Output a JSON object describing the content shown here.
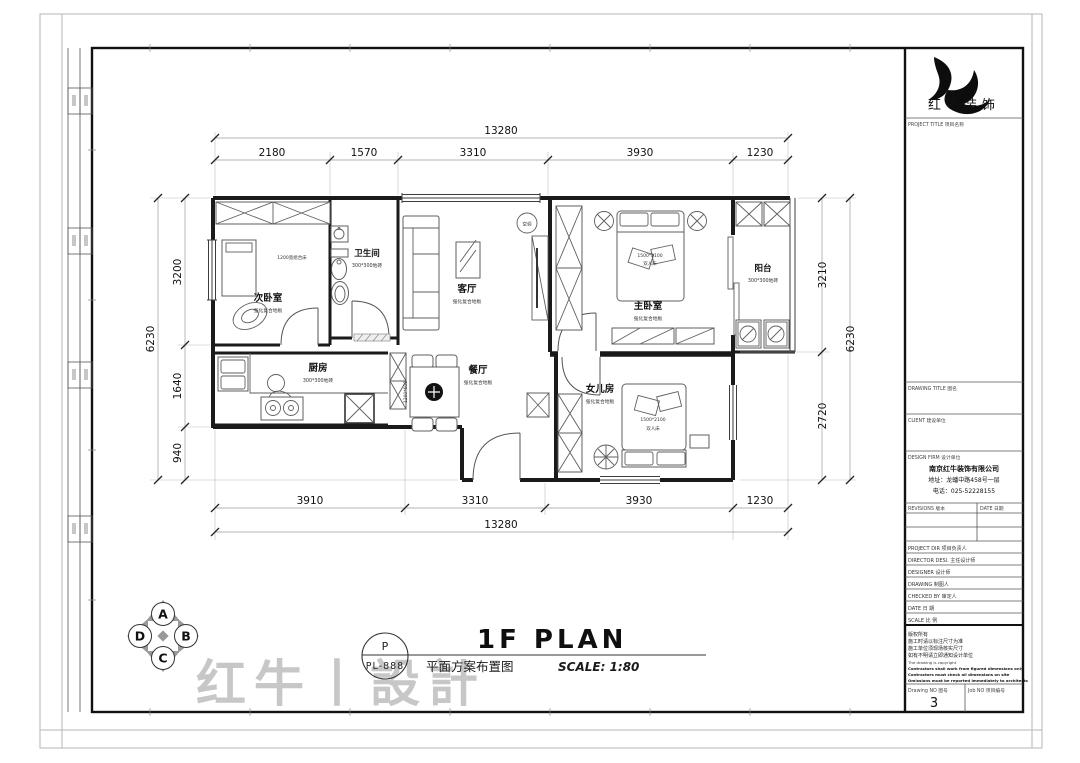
{
  "sheet": {
    "plan_title_en": "1F PLAN",
    "plan_title_cn": "平面方案布置图",
    "scale_note": "SCALE: 1:80",
    "stamp_letter": "P",
    "stamp_code": "PL-888",
    "watermark": "红牛丨設計",
    "compass": {
      "top": "A",
      "right": "B",
      "bottom": "C",
      "left": "D"
    }
  },
  "title_block": {
    "company_logo_text": "红牛装饰",
    "project_title_label": "PROJECT TITLE 项目名称",
    "drawing_title_label": "DRAWING TITLE 图名",
    "client_label": "CLIENT 建设单位",
    "design_firm_label": "DESIGN FIRM 设计单位",
    "firm_name": "南京红牛装饰有限公司",
    "firm_address": "地址：龙蟠中路458号一层",
    "firm_phone": "电话：025-52228155",
    "revisions_label": "REVISIONS 版本",
    "date_col_label": "DATE 日期",
    "rows": {
      "project_dir": "PROJECT DIR  项目负责人",
      "director": "DIRECTOR DESI.  主任设计师",
      "designer": "DESIGNER  设计师",
      "drawing": "DRAWING  制图人",
      "checked": "CHECKED BY  审定人",
      "date": "DATE  日  期",
      "scale": "SCALE  比  例"
    },
    "notes": {
      "l1": "版权所有",
      "l2": "施工时请以标注尺寸为准",
      "l3": "施工单位须现场核实尺寸",
      "l4": "如有不明请立即通知设计单位",
      "l5": "The drawing is copyright",
      "l6": "Contractors shall work from figured dimensions only",
      "l7": "Contractors must check all dimensions on site",
      "l8": "Omissions must be reported immediately to architects"
    },
    "drawing_no_label": "Drawing NO  图号",
    "drawing_no_value": "3",
    "job_no_label": "Job NO  项目编号"
  },
  "plan": {
    "ac_label": "空调",
    "rooms": {
      "second_bedroom": {
        "name": "次卧室",
        "floor": "强化复合地板",
        "bed_note": "1200宽组合床"
      },
      "bathroom": {
        "name": "卫生间",
        "floor": "300*300地砖"
      },
      "living": {
        "name": "客厅",
        "floor": "强化复合地板"
      },
      "master_bedroom": {
        "name": "主卧室",
        "floor": "强化复合地板",
        "bed_size": "1500*2100",
        "bed_type": "双人床"
      },
      "balcony": {
        "name": "阳台",
        "floor": "300*300地砖"
      },
      "kitchen": {
        "name": "厨房",
        "floor": "300*300地砖"
      },
      "dining": {
        "name": "餐厅",
        "floor": "强化复合地板",
        "table_size": "1200*600"
      },
      "daughter_room": {
        "name": "女儿房",
        "floor": "强化复合地板",
        "bed_size": "1500*2100",
        "bed_type": "双人床"
      }
    },
    "dims": {
      "top_total": "13280",
      "top_segments": [
        "2180",
        "1570",
        "3310",
        "3930",
        "1230"
      ],
      "bottom_segments": [
        "3910",
        "3310",
        "3930",
        "1230"
      ],
      "bottom_total": "13280",
      "left_total": "6230",
      "left_segments": [
        "3200",
        "1640",
        "940"
      ],
      "right_segments": [
        "3210",
        "2720"
      ],
      "right_total": "6230"
    }
  }
}
